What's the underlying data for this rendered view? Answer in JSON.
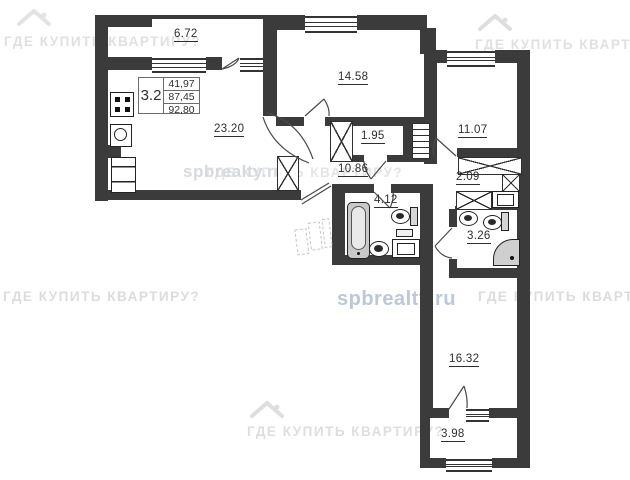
{
  "plan": {
    "legend": {
      "rooms_count": "3.2",
      "values": [
        "41,97",
        "87,45",
        "92,80"
      ]
    },
    "rooms": [
      {
        "name": "balcony-top",
        "area": "6.72"
      },
      {
        "name": "room-top",
        "area": "14.58"
      },
      {
        "name": "room-right",
        "area": "11.07"
      },
      {
        "name": "kitchen-living",
        "area": "23.20"
      },
      {
        "name": "storage",
        "area": "1.95"
      },
      {
        "name": "hallway",
        "area": "10.86"
      },
      {
        "name": "corridor",
        "area": "2.09"
      },
      {
        "name": "bathroom",
        "area": "4.12"
      },
      {
        "name": "shower-room",
        "area": "3.26"
      },
      {
        "name": "room-bottom",
        "area": "16.32"
      },
      {
        "name": "balcony-bottom",
        "area": "3.98"
      }
    ]
  },
  "watermarks": {
    "brand": "ГДЕ КУПИТЬ КВАРТИРУ?",
    "site": "spbrealty.ru"
  }
}
